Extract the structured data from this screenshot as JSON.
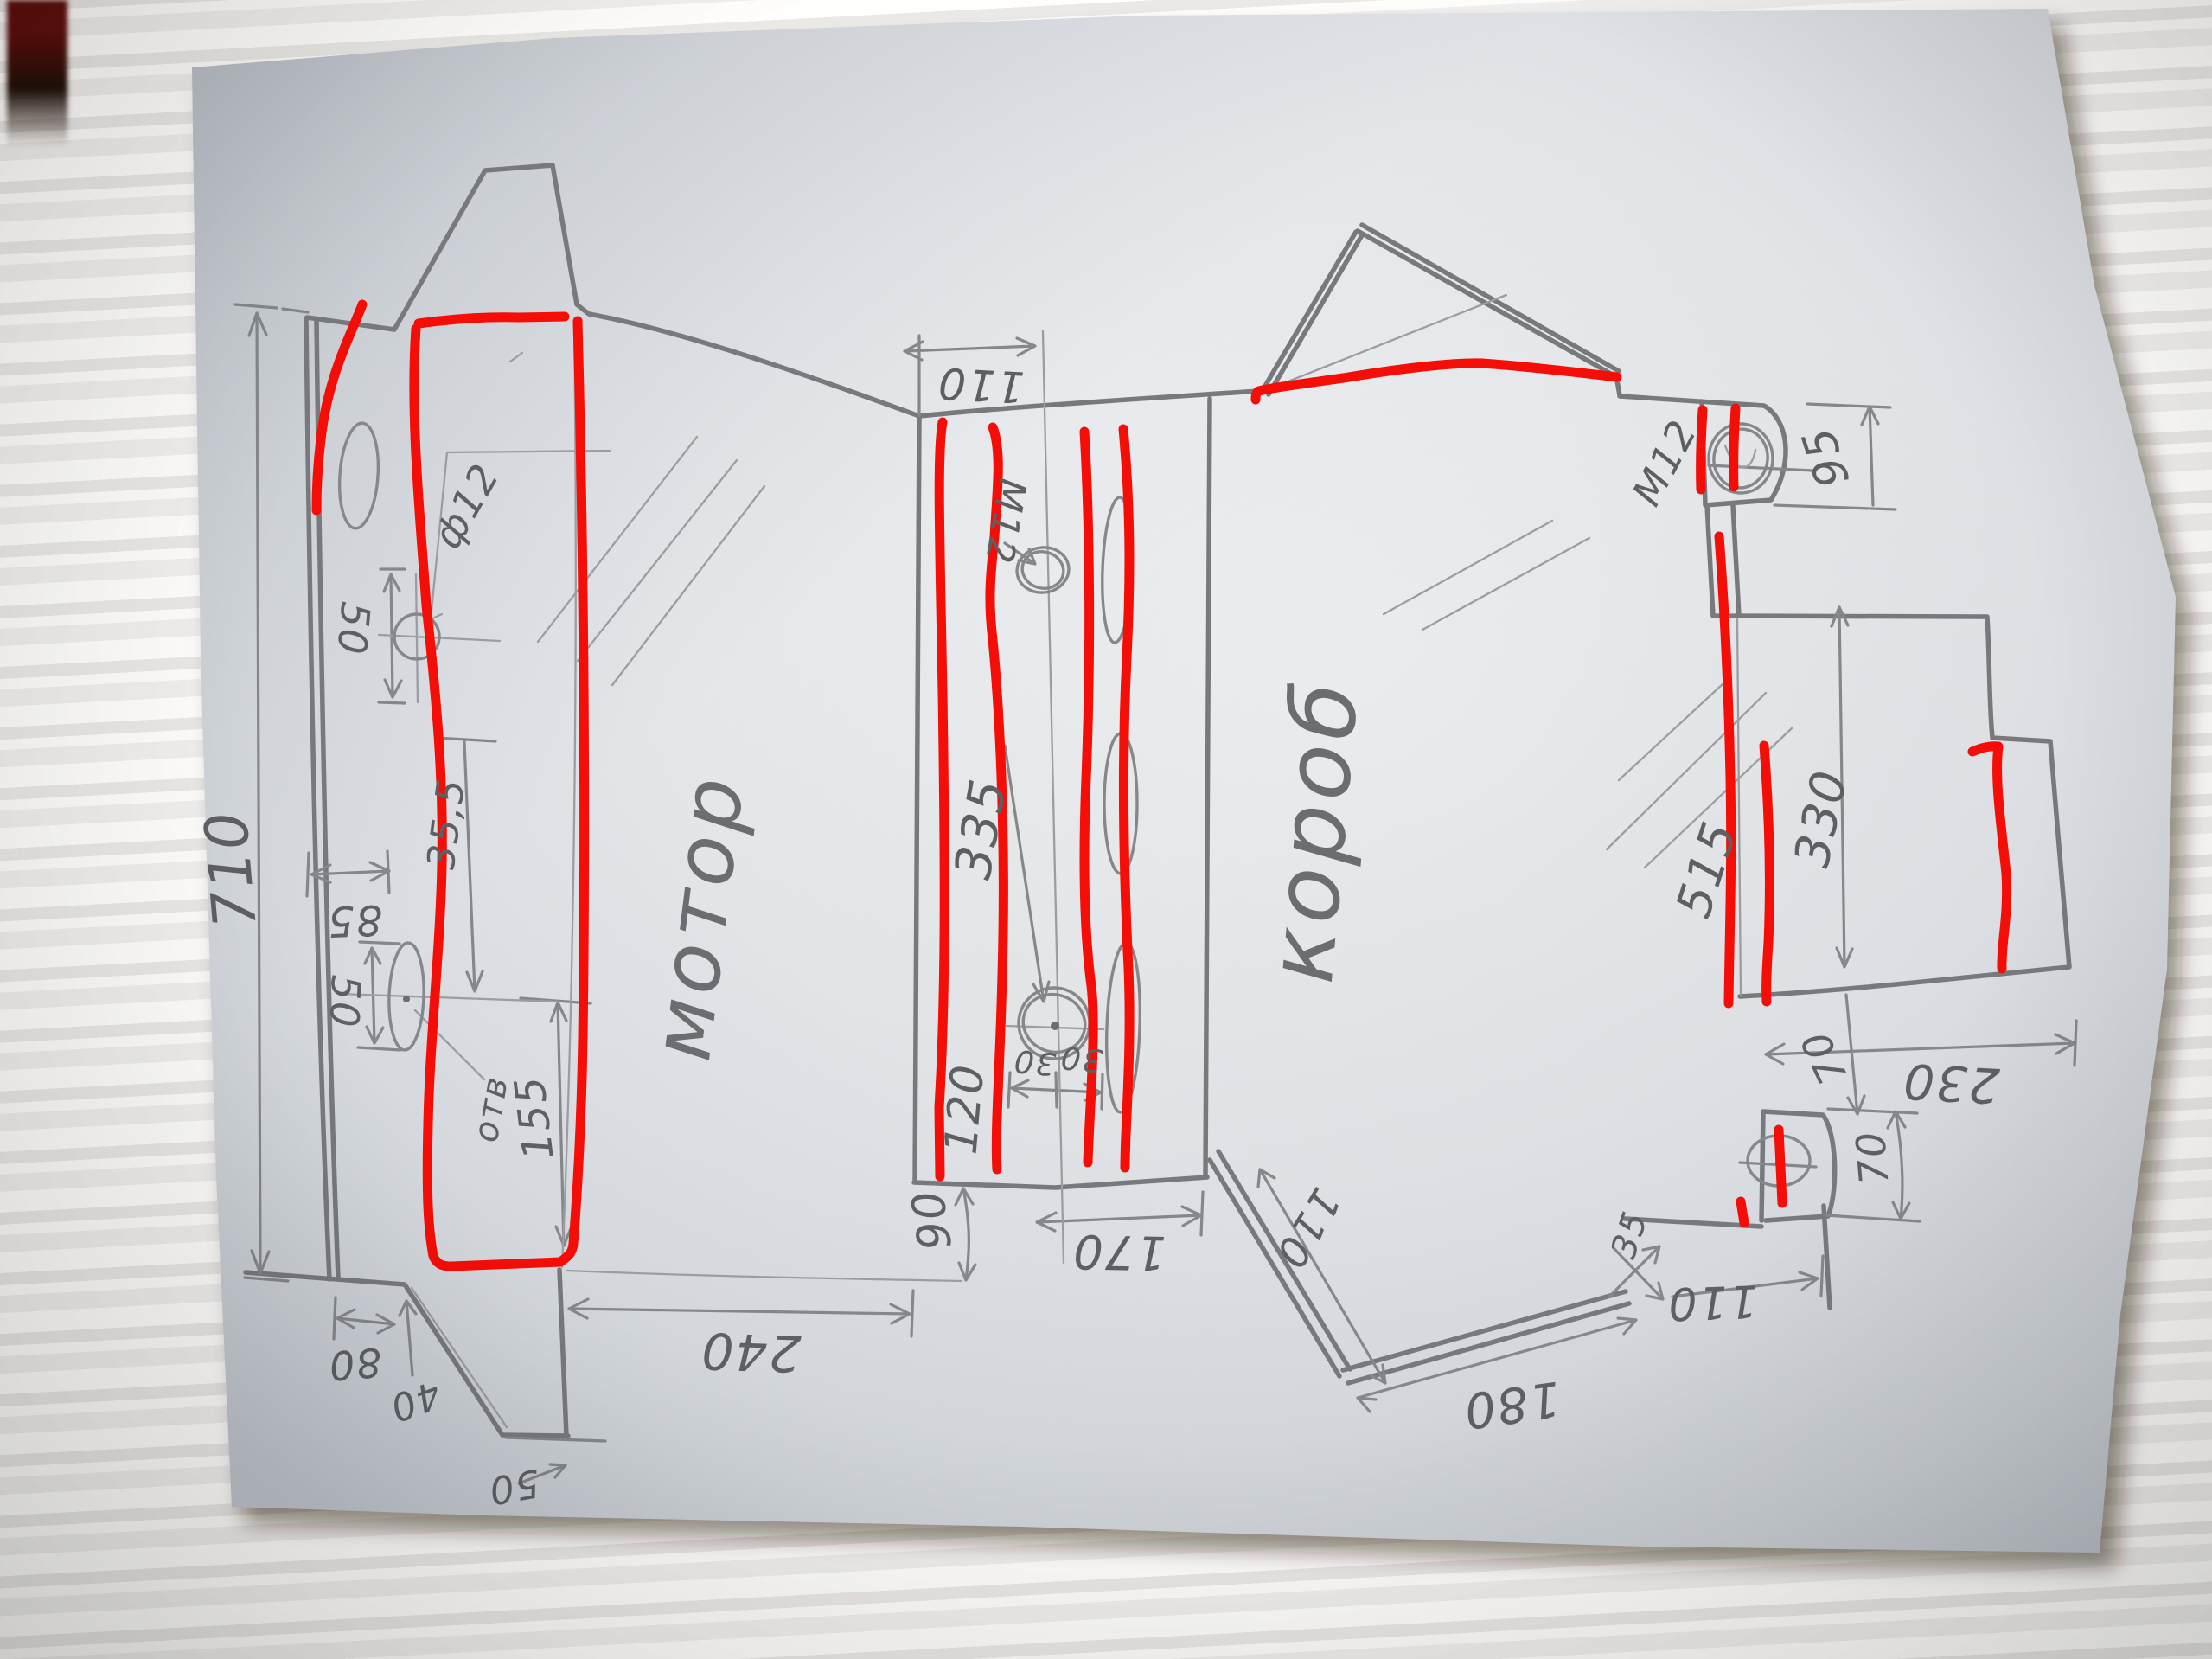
{
  "colors": {
    "red": "#f50d07",
    "pencil": "#77797c",
    "pencil_light": "#9b9da1",
    "pencil_dark": "#5d5f63",
    "paper": "#e7e9ec",
    "desk": "#a5713d"
  },
  "labels": {
    "left": {
      "word": "мотор",
      "overall_height": "710",
      "slot_offset": "85",
      "hole_dia": "ф12",
      "hole_pitch_top": "50",
      "hole_offset": "35,5",
      "hole_pitch_mid": "50",
      "bottom_height": "155",
      "hole_note": "отв",
      "foot_80": "80",
      "foot_40": "40",
      "foot_50": "50"
    },
    "middle": {
      "top_offset": "110",
      "thread": "M12",
      "length": "335",
      "lower_length": "120",
      "hole_30_left": "30",
      "hole_30_right": "30",
      "step": "90",
      "gap_240": "240",
      "gap_170": "170"
    },
    "right": {
      "word": "короб",
      "tab_thread": "M12",
      "tab_height": "95",
      "height_515": "515",
      "ext_height": "330",
      "ext_top_70": "70",
      "ext_width": "230",
      "tab2_height": "70",
      "strut_110": "110",
      "strut_180": "180",
      "bracket_110": "110",
      "bracket_35": "35"
    }
  }
}
